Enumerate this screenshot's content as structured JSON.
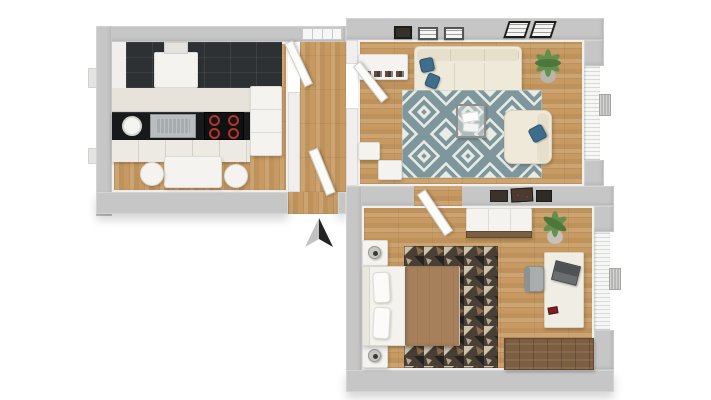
{
  "title": "apartment-3d-floor-plan",
  "colors": {
    "wall": "#c6c6c6",
    "wallFace": "#f0efed",
    "wood": "#c89a61",
    "kitchenFeatureWall": "#2e3133",
    "worktop": "#17191a",
    "cabinet": "#eceae3",
    "cream": "#efe9d9",
    "rugTeal": "#7e979d",
    "rugCream": "#e9ebe5",
    "bedroomRugBase": "#4a3f35",
    "rugAccentCream": "#cfc3ab",
    "rugAccentBrown": "#8a6c4e",
    "rugAccentBlack": "#262220",
    "blanket": "#a6805b",
    "pillowBlue": "#3f6d8c",
    "plantGreen": "#5e8f4d",
    "plantGreenDark": "#47753a",
    "chestWood": "#7c5e40",
    "burnerRed": "#b5342a",
    "steel": "#b9bdbf",
    "curtain": "#f7f7f5",
    "arrowDark": "#232323",
    "arrowLight": "#c2c2c2"
  },
  "rooms": {
    "kitchen": {
      "name": "Kitchen",
      "furniture": [
        "black tiled feature wall",
        "extractor hood",
        "countertop with sink",
        "stove with four burners",
        "plate",
        "base cabinets",
        "refrigerator",
        "dining table",
        "two round chairs"
      ]
    },
    "living_room": {
      "name": "Living room",
      "furniture": [
        "sideboard with books",
        "three-seat cream sofa",
        "two blue throw pillows",
        "teal diamond rug",
        "metal coffee table with magazines",
        "cream armchair with blue pillow",
        "potted plant",
        "five wall frames",
        "two media cabinets",
        "window with curtains",
        "radiator"
      ]
    },
    "bedroom": {
      "name": "Bedroom",
      "furniture": [
        "double bed with brown blanket",
        "two white pillows",
        "two nightstands with lamps",
        "dark patterned rug",
        "dresser",
        "potted plant",
        "wall art collage",
        "desk with laptop",
        "gray desk chair",
        "wooden storage chest",
        "window with curtains",
        "radiator"
      ]
    },
    "hallway": {
      "name": "Hallway",
      "furniture": [
        "entrance door",
        "interior doors",
        "window"
      ]
    }
  },
  "entrance": {
    "marker": "north-arrow",
    "direction": "up"
  }
}
